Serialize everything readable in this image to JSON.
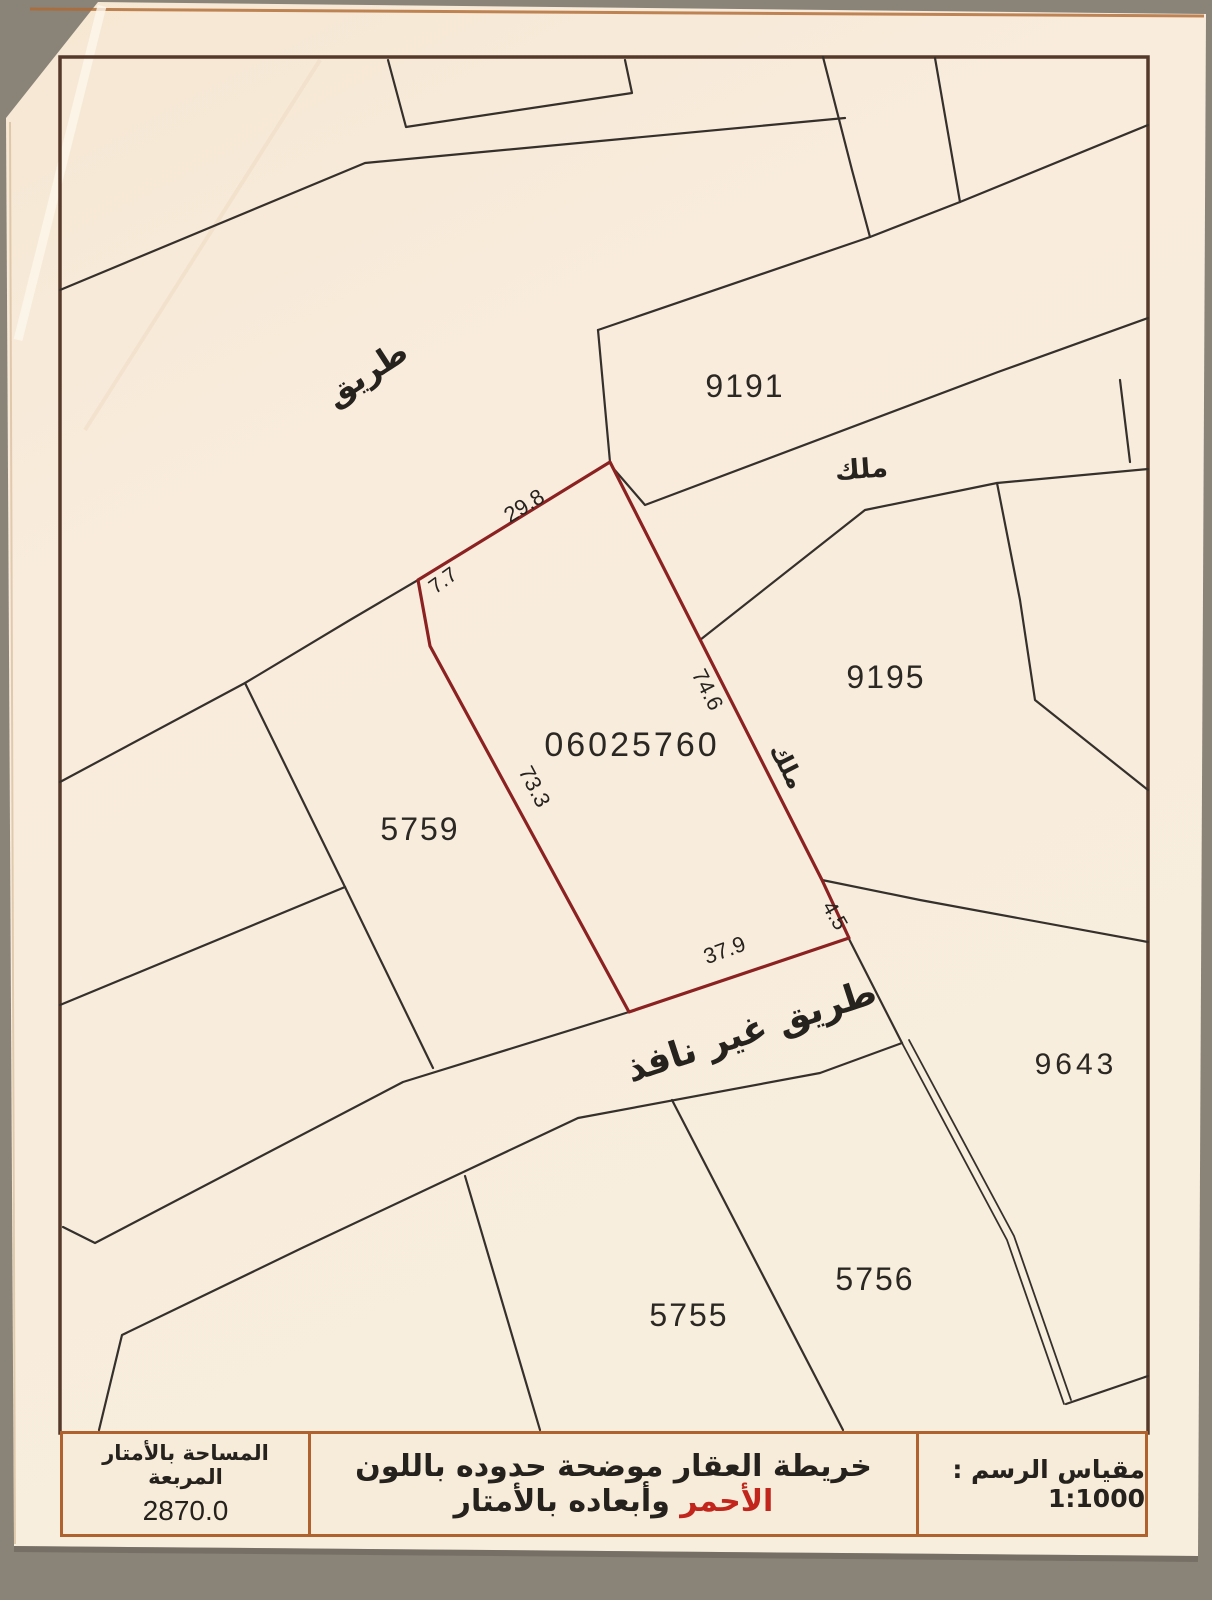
{
  "colors": {
    "boundary_red": "#8c2121",
    "parcel_ink": "#35302b",
    "frame_brown": "#55392a",
    "table_border_orange": "#b0622e",
    "paper": "#f8eedd",
    "note_red_text": "#c1251c"
  },
  "map": {
    "subject_plot": {
      "number": "06025760",
      "dimensions": {
        "top": "29.8",
        "upper_left": "7.7",
        "right": "74.6",
        "left": "73.3",
        "bottom": "37.9",
        "bottom_right": "4.5"
      }
    },
    "parcels": {
      "p9191": "9191",
      "p9195": "9195",
      "p5759": "5759",
      "p9643": "9643",
      "p5755": "5755",
      "p5756": "5756"
    },
    "annotations": {
      "road": "طريق",
      "owner_upper": "ملك",
      "owner_side": "ملك",
      "dead_end_road": "طريق غير نافذ"
    }
  },
  "footer": {
    "area_label": "المساحة بالأمتار المربعة",
    "area_value": "2870.0",
    "note_part1": "خريطة العقار موضحة حدوده باللون",
    "note_red": "الأحمر",
    "note_part2": "وأبعاده بالأمتار",
    "scale_label": "مقياس الرسم : 1:1000"
  }
}
